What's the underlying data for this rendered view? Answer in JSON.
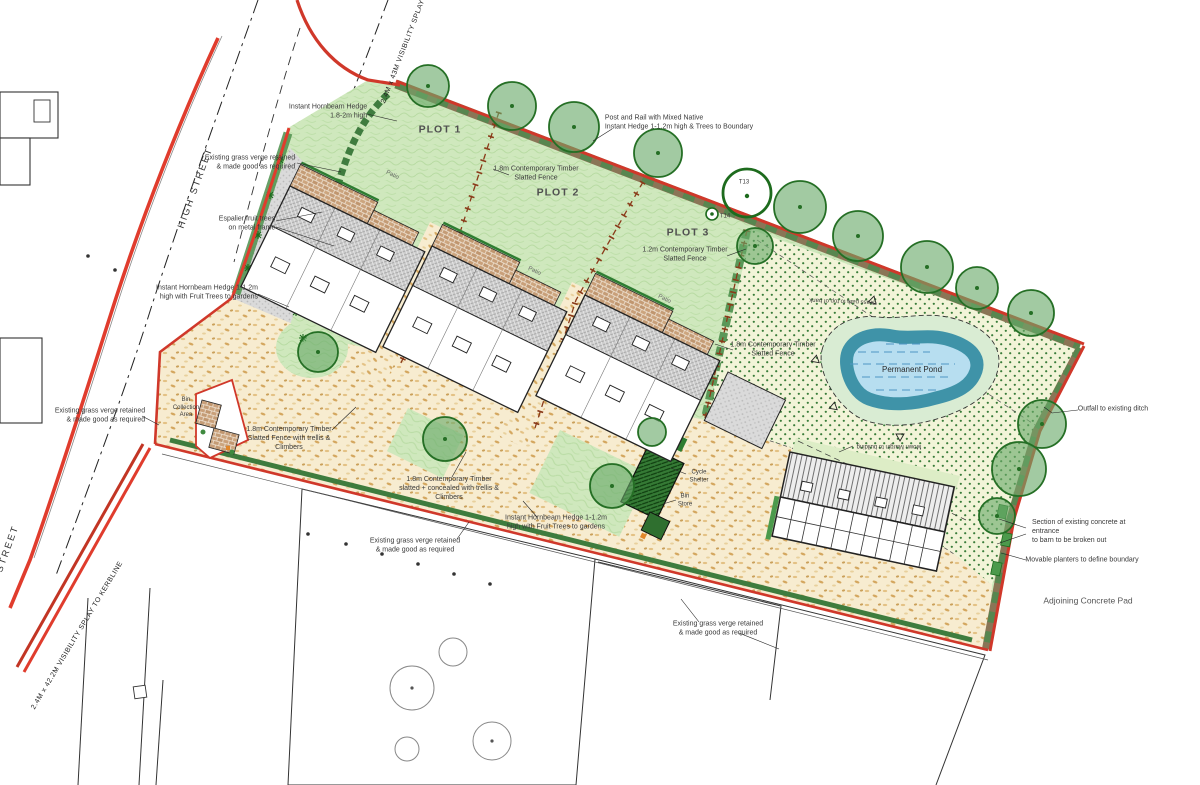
{
  "drawing": {
    "title": "Residential landscape site plan - 3 plots with barn and pond",
    "plots": {
      "plot1": "PLOT 1",
      "plot2": "PLOT 2",
      "plot3": "PLOT 3"
    },
    "roads": {
      "high_street": "HIGH STREET",
      "visibility_splay_top": "2.4M x 43M VISIBILITY SPLAY",
      "visibility_splay_bottom": "2.4M x 42.2M VISIBILITY SPLAY TO KERBLINE"
    },
    "annotations": {
      "instant_hornbeam_hedge_tall": "Instant Hornbeam Hedge\n1.8-2m high",
      "existing_grass_verge": "Existing grass verge retained\n& made good as required",
      "espalier_fruit_trees": "Espalier fruit trees\non metal frame",
      "instant_hornbeam_hedge_fruit": "Instant Hornbeam Hedge 1-1.2m\nhigh with Fruit Trees to gardens",
      "post_and_rail": "Post and Rail with Mixed Native\nInstant Hedge 1-1.2m high & Trees to Boundary",
      "fence_18_slatted": "1.8m Contemporary Timber\nSlatted Fence",
      "fence_12_slatted": "1.2m Contemporary Timber\nSlatted Fence",
      "fence_18_trellis": "1.8m Contemporary Timber\nSlatted Fence with trellis &\nClimbers",
      "fence_18_concealed": "1.8m Contemporary Timber\nslatted + concealed with trellis &\nClimbers",
      "grass_path": "Grass path to top of bank",
      "mown_margin": "Mown Margin to building",
      "outfall": "Outfall to existing ditch",
      "section_concrete": "Section of existing concrete at entrance\nto barn to be broken out",
      "movable_planters": "Movable planters to define boundary",
      "adjoining_pad": "Adjoining Concrete Pad"
    },
    "features": {
      "permanent_pond": "Permanent Pond",
      "bin_collection_area": "Bin\nCollection\nArea",
      "cycle_shelter": "Cycle\nShelter",
      "bin_store": "Bin\nStore",
      "patio": "Patio"
    },
    "tree_markers": {
      "t13": "T13",
      "t14": "T14"
    },
    "colors": {
      "boundary_red": "#d0382a",
      "kerb_red": "#e03c2d",
      "lawn_green": "#cfe8bd",
      "meadow_cream": "#f2f4d8",
      "sand_beige": "#f7ecd0",
      "hedge_brown": "#8a7556",
      "tree_green": "#5ea45e",
      "fence_brown": "#8a3a19",
      "pond_water_blue": "#b7def0",
      "pond_bank_teal": "#3f93a8",
      "roof_grey": "#cccccc",
      "patio_brick": "#c9a07a"
    }
  }
}
